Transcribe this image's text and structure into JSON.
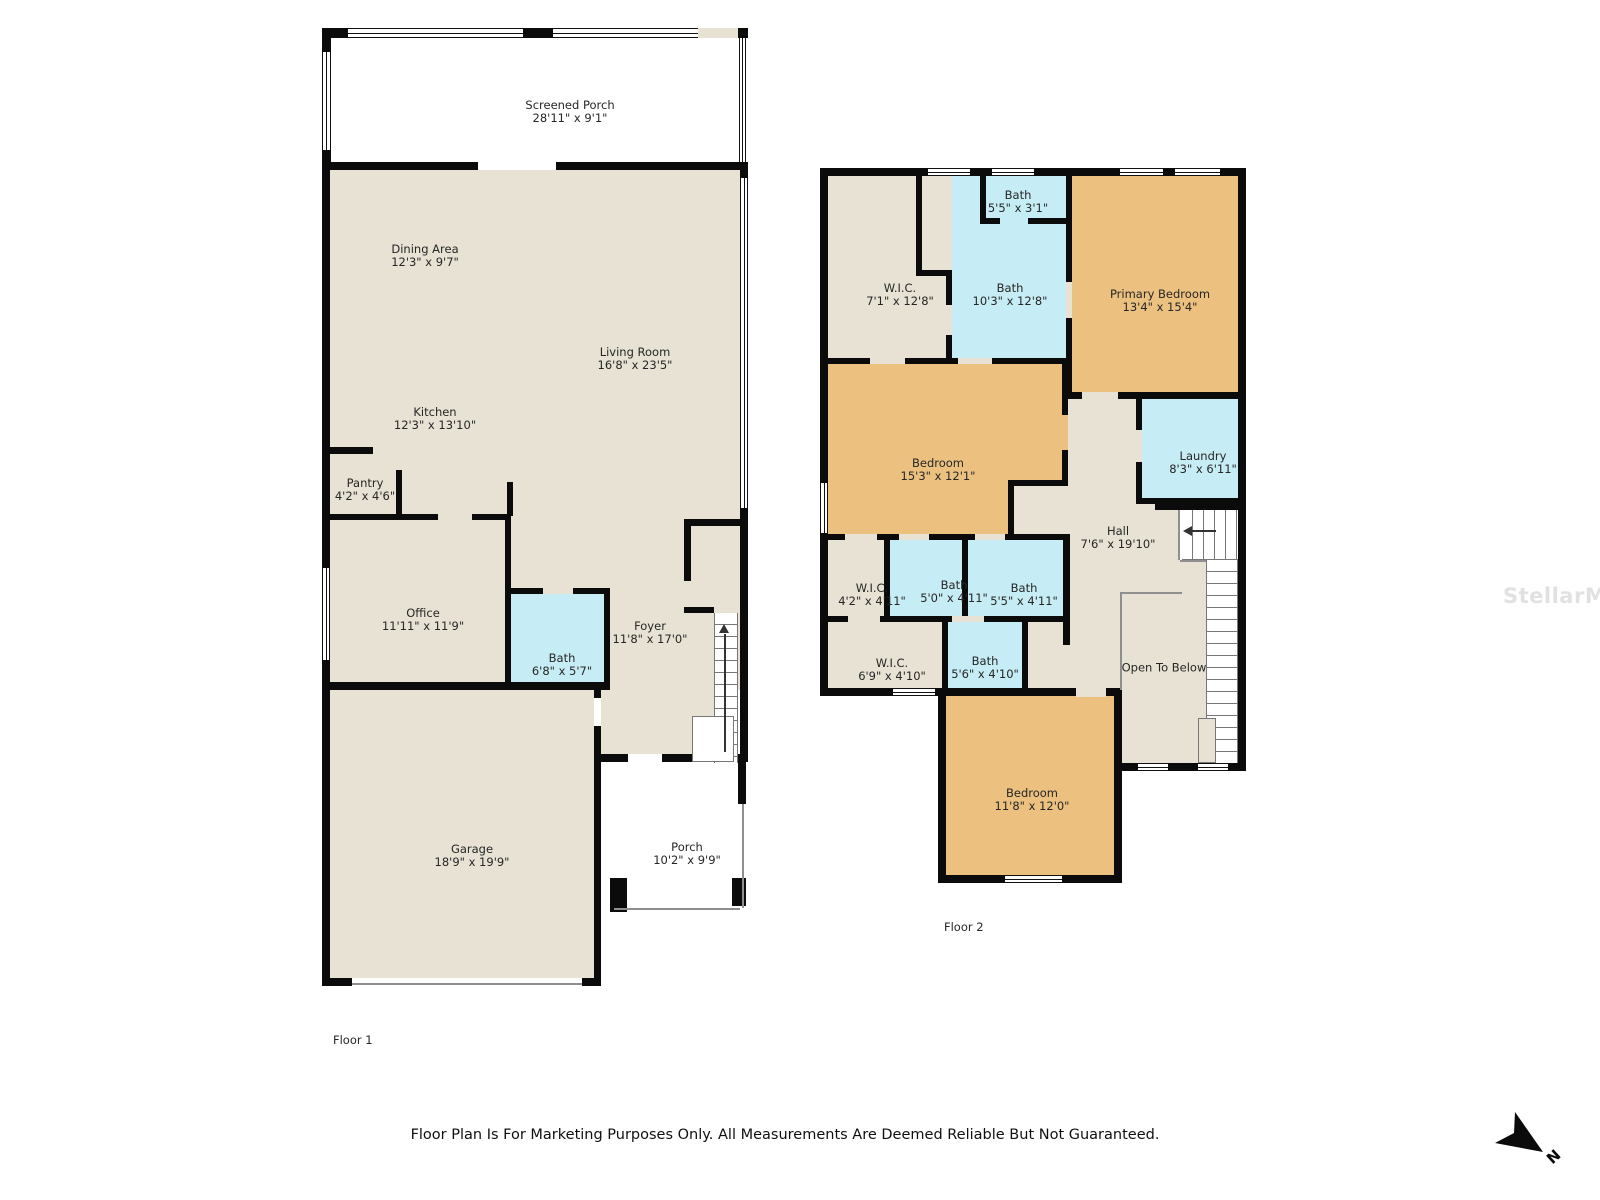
{
  "colors": {
    "wall": "#0b0b0b",
    "floor_beige": "#e7e2d3",
    "bedroom_orange": "#ecc180",
    "bath_blue": "#c6edf5",
    "porch_white": "#ffffff"
  },
  "floor1": {
    "label": "Floor 1",
    "rooms": [
      {
        "name": "Screened Porch",
        "dims": "28'11\" x 9'1\""
      },
      {
        "name": "Dining Area",
        "dims": "12'3\" x 9'7\""
      },
      {
        "name": "Living Room",
        "dims": "16'8\" x 23'5\""
      },
      {
        "name": "Kitchen",
        "dims": "12'3\" x 13'10\""
      },
      {
        "name": "Pantry",
        "dims": "4'2\" x 4'6\""
      },
      {
        "name": "Office",
        "dims": "11'11\" x 11'9\""
      },
      {
        "name": "Bath",
        "dims": "6'8\" x 5'7\""
      },
      {
        "name": "Foyer",
        "dims": "11'8\" x 17'0\""
      },
      {
        "name": "Garage",
        "dims": "18'9\" x 19'9\""
      },
      {
        "name": "Porch",
        "dims": "10'2\" x 9'9\""
      }
    ]
  },
  "floor2": {
    "label": "Floor 2",
    "rooms": [
      {
        "name": "Bath",
        "dims": "5'5\" x 3'1\""
      },
      {
        "name": "W.I.C.",
        "dims": "7'1\" x 12'8\""
      },
      {
        "name": "Bath",
        "dims": "10'3\" x 12'8\""
      },
      {
        "name": "Primary Bedroom",
        "dims": "13'4\" x 15'4\""
      },
      {
        "name": "Bedroom",
        "dims": "15'3\" x 12'1\""
      },
      {
        "name": "Laundry",
        "dims": "8'3\" x 6'11\""
      },
      {
        "name": "Hall",
        "dims": "7'6\" x 19'10\""
      },
      {
        "name": "W.I.C.",
        "dims": "4'2\" x 4'11\""
      },
      {
        "name": "Bath",
        "dims": "5'0\" x 4'11\""
      },
      {
        "name": "Bath",
        "dims": "5'5\" x 4'11\""
      },
      {
        "name": "W.I.C.",
        "dims": "6'9\" x 4'10\""
      },
      {
        "name": "Bath",
        "dims": "5'6\" x 4'10\""
      },
      {
        "name": "Open To Below",
        "dims": ""
      },
      {
        "name": "Bedroom",
        "dims": "11'8\" x 12'0\""
      }
    ]
  },
  "footer": {
    "disclaimer": "Floor Plan Is For Marketing Purposes Only. All Measurements Are Deemed Reliable But Not Guaranteed."
  },
  "compass": {
    "label": "N"
  },
  "watermark": {
    "text": "StellarMLS"
  }
}
